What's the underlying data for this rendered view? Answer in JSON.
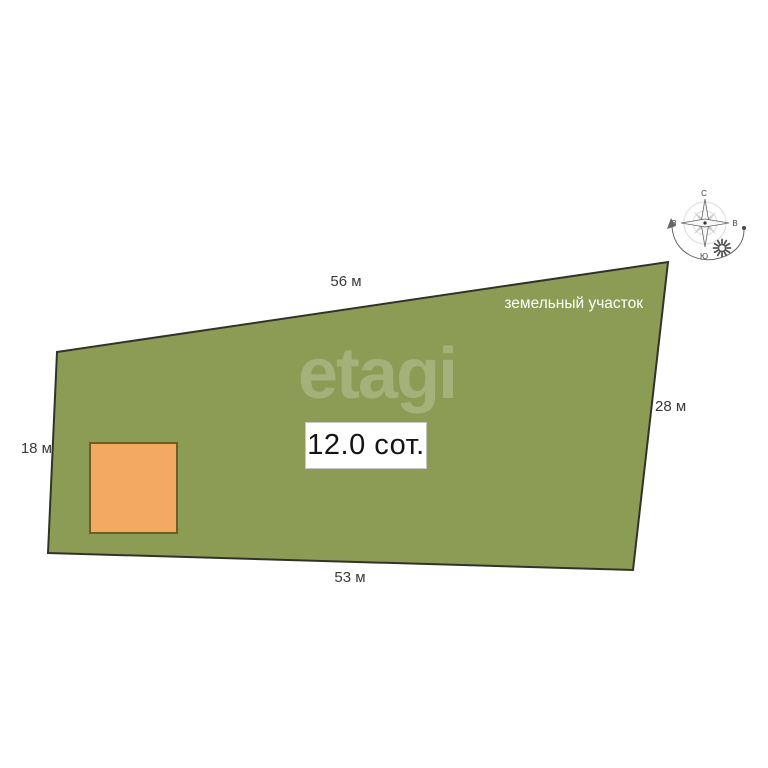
{
  "scene": {
    "title": "земельный участок",
    "area_label": "12.0 сот.",
    "watermark": "etagi",
    "dimensions": {
      "top": "56 м",
      "right": "28 м",
      "bottom": "53 м",
      "left": "18 м"
    },
    "compass": {
      "north": "С",
      "south": "Ю",
      "east": "В",
      "west": "З"
    },
    "colors": {
      "background": "#ffffff",
      "plot_fill": "#8c9c55",
      "plot_outline": "#32322a",
      "building_fill": "#f4a963",
      "building_outline": "#6b5e26"
    }
  }
}
